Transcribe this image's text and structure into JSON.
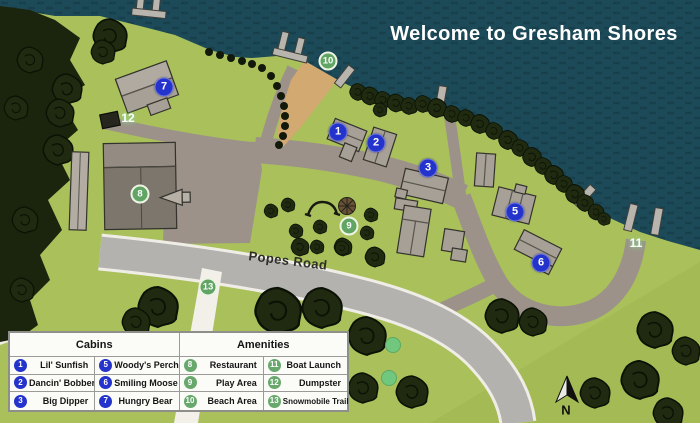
{
  "title": "Welcome to Gresham Shores",
  "map": {
    "road_label": "Popes Road",
    "north_label": "N"
  },
  "markers": [
    {
      "label": "1"
    },
    {
      "label": "2"
    },
    {
      "label": "3"
    },
    {
      "label": "5"
    },
    {
      "label": "6"
    },
    {
      "label": "7"
    },
    {
      "label": "8"
    },
    {
      "label": "9"
    },
    {
      "label": "10"
    },
    {
      "label": "11"
    },
    {
      "label": "12"
    },
    {
      "label": "13"
    }
  ],
  "legend": {
    "cabins_header": "Cabins",
    "amenities_header": "Amenities",
    "cabins": [
      {
        "num": "1",
        "name": "Lil' Sunfish"
      },
      {
        "num": "2",
        "name": "Dancin' Bobber"
      },
      {
        "num": "3",
        "name": "Big Dipper"
      },
      {
        "num": "5",
        "name": "Woody's Perch"
      },
      {
        "num": "6",
        "name": "Smiling Moose"
      },
      {
        "num": "7",
        "name": "Hungry Bear"
      }
    ],
    "amenities": [
      {
        "num": "8",
        "name": "Restaurant"
      },
      {
        "num": "9",
        "name": "Play Area"
      },
      {
        "num": "10",
        "name": "Beach Area"
      },
      {
        "num": "11",
        "name": "Boat Launch"
      },
      {
        "num": "12",
        "name": "Dumpster"
      },
      {
        "num": "13",
        "name": "Snowmobile Trail"
      }
    ]
  },
  "colors": {
    "water": "#1d4a58",
    "grass": "#a9c05b",
    "main_road": "#b3b2ae",
    "driveway": "#9c9289",
    "beach": "#d3a972",
    "cabin_marker": "#2433cb",
    "amenity_marker": "#61a565"
  }
}
